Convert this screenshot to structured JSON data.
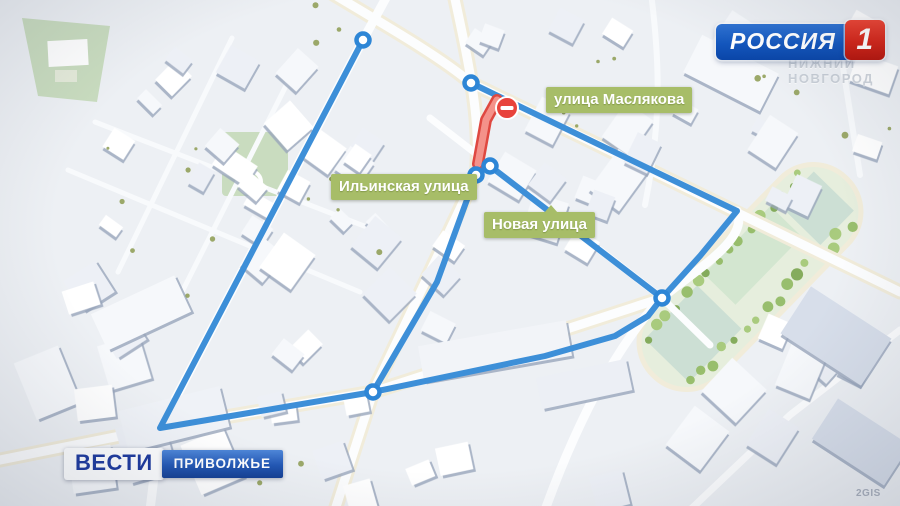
{
  "channel_logo": {
    "name": "РОССИЯ",
    "channel_number": "1"
  },
  "program_logo": {
    "title": "ВЕСТИ",
    "region": "ПРИВОЛЖЬЕ"
  },
  "watermarks": {
    "city_line1": "НИЖНИЙ",
    "city_line2": "НОВГОРОД",
    "map_provider": "2GIS"
  },
  "street_labels": [
    {
      "text": "улица Маслякова",
      "x": 546,
      "y": 87,
      "pointer": "none"
    },
    {
      "text": "Ильинская улица",
      "x": 331,
      "y": 174,
      "pointer": "none"
    },
    {
      "text": "Новая улица",
      "x": 484,
      "y": 212,
      "pointer": "top"
    }
  ],
  "route": {
    "color": "#3d8fd8",
    "node_fill": "#ffffff",
    "node_stroke": "#2e86d6",
    "paths": [
      [
        [
          363,
          40
        ],
        [
          160,
          428
        ],
        [
          373,
          392
        ]
      ],
      [
        [
          373,
          392
        ],
        [
          545,
          356
        ],
        [
          615,
          336
        ],
        [
          648,
          316
        ],
        [
          662,
          298
        ]
      ],
      [
        [
          662,
          298
        ],
        [
          700,
          256
        ],
        [
          737,
          211
        ],
        [
          471,
          83
        ]
      ],
      [
        [
          490,
          166
        ],
        [
          662,
          298
        ]
      ],
      [
        [
          476,
          175
        ],
        [
          437,
          282
        ],
        [
          373,
          392
        ]
      ]
    ],
    "nodes": [
      [
        363,
        40
      ],
      [
        471,
        83
      ],
      [
        490,
        166
      ],
      [
        476,
        175
      ],
      [
        662,
        298
      ],
      [
        373,
        392
      ]
    ],
    "closure": {
      "outer_color": "#df4840",
      "inner_color": "#f4928a",
      "points": [
        [
          497,
          100
        ],
        [
          486,
          120
        ],
        [
          478,
          164
        ]
      ],
      "sign": {
        "x": 507,
        "y": 108,
        "color": "#e8433c",
        "bar_color": "#ffffff"
      }
    }
  }
}
